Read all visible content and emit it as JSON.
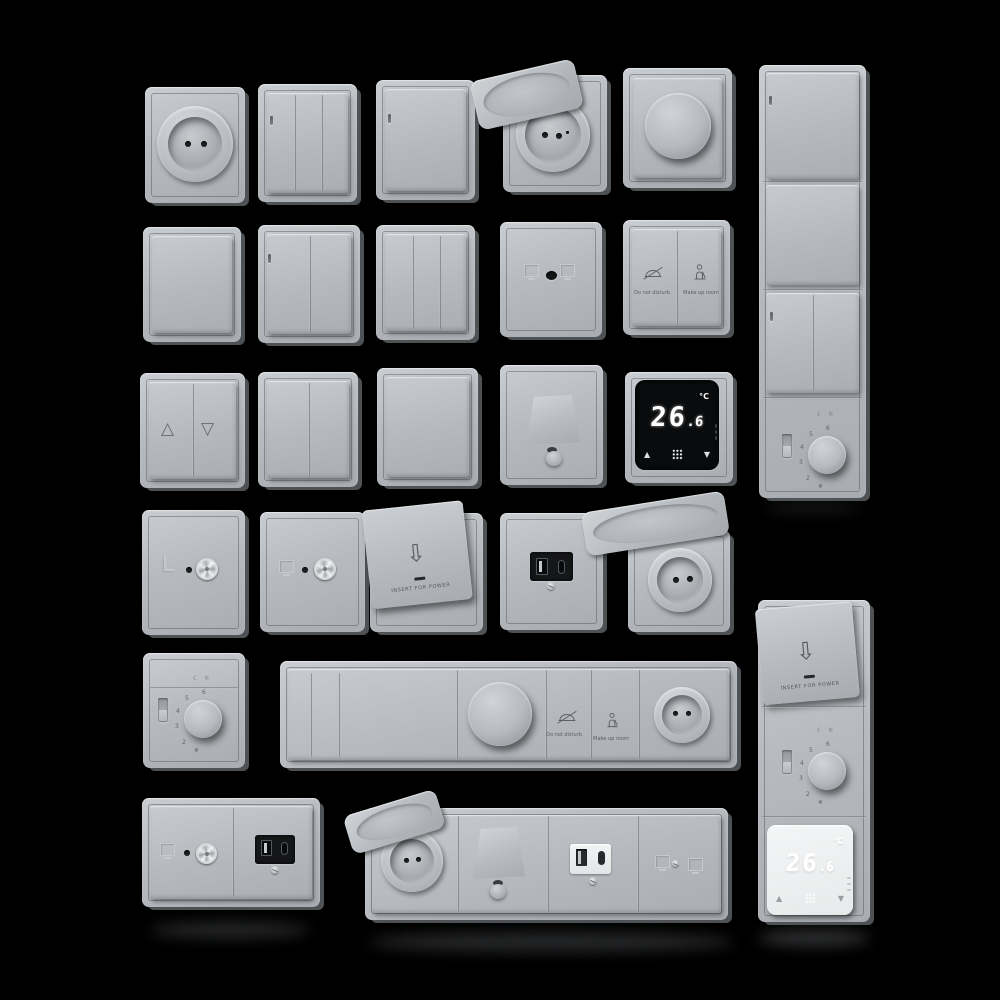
{
  "scene": {
    "background": "#000000",
    "plate_color": "#b7bbc0",
    "plate_edge_color": "#4e5255",
    "screen_black": "#0a0b0c",
    "screen_white": "#eef0f1",
    "metal_color": "#d6d9db",
    "usb_module_black": "#151618"
  },
  "icons": {
    "blinds_up": "△",
    "blinds_down": "▽",
    "card_arrow": "⇩",
    "arrow_up": "▲",
    "arrow_down": "▼",
    "moon": "☾",
    "sun": "☼",
    "snowflake": "❄"
  },
  "labels": {
    "do_not_disturb": "Do not disturb",
    "make_up_room": "Make up room",
    "insert_for_power": "INSERT FOR POWER"
  },
  "thermostat": {
    "temp_int": "26",
    "temp_frac": ".6",
    "unit": "°C"
  },
  "dial": {
    "numbers": [
      "6",
      "5",
      "4",
      "3",
      "2"
    ]
  },
  "items": [
    {
      "row": 1,
      "fixtures": [
        "round euro socket",
        "3-gang switch",
        "1-gang switch",
        "socket with hinged lid open",
        "rotary dimmer",
        "vertical 4-module panel: switch, blank rocker, 2-gang switch, dial thermostat"
      ]
    },
    {
      "row": 2,
      "fixtures": [
        "blank cover plate",
        "2-gang switch",
        "3-gang switch",
        "TV/data outlet",
        "hotel do-not-disturb / make-up-room switch"
      ]
    },
    {
      "row": 3,
      "fixtures": [
        "roller-shutter switch",
        "2-gang switch",
        "1-gang blank rocker",
        "cable outlet with spout",
        "digital thermostat black 26.6°C"
      ]
    },
    {
      "row": 4,
      "fixtures": [
        "coax outlet",
        "coax outlet",
        "key-card power holder",
        "USB A+C outlet black",
        "socket with hinged lid open"
      ]
    },
    {
      "row": 5,
      "fixtures": [
        "dial thermostat",
        "horizontal panel: 2 narrow keys, wide rocker, dimmer, do-not-disturb key, make-up-room key, socket",
        "vertical panel: key-card holder, dial thermostat, digital thermostat white 26.6°C"
      ]
    },
    {
      "row": 6,
      "fixtures": [
        "double frame: coax outlet + USB A+C outlet black",
        "horizontal panel: lidded socket, cable outlet, USB A+C outlet white, coax outlet"
      ]
    }
  ]
}
